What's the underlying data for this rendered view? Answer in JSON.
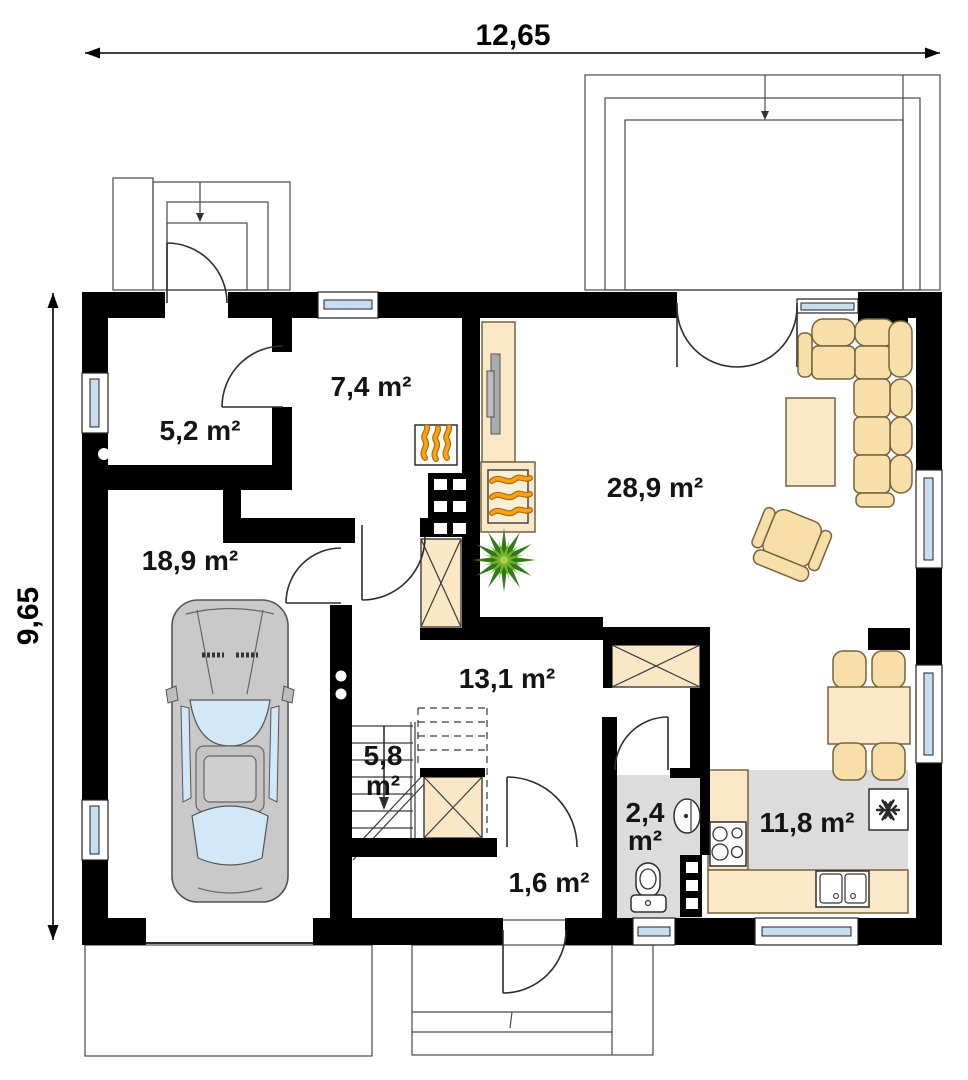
{
  "dimensions": {
    "width_label": "12,65",
    "height_label": "9,65"
  },
  "rooms": {
    "wardrobe": {
      "area": "5,2 m²"
    },
    "hall_upper": {
      "area": "7,4 m²"
    },
    "garage": {
      "area": "18,9 m²"
    },
    "living_room": {
      "area": "28,9 m²"
    },
    "hall_lower": {
      "area": "13,1 m²"
    },
    "stairs": {
      "area_value": "5,8",
      "area_unit": "m²"
    },
    "bathroom": {
      "area_value": "2,4",
      "area_unit": "m²"
    },
    "vestibule": {
      "area": "1,6 m²"
    },
    "kitchen": {
      "area": "11,8 m²"
    }
  },
  "colors": {
    "wall": "#000000",
    "furniture": "#F8DEA9",
    "wet_floor": "#DCDCDC",
    "glazing": "#C9DDF1",
    "flame": "#F6A21A",
    "plant": "#3E8A1C",
    "car_body": "#C9C9C9",
    "car_glass": "#D2E8F7"
  }
}
